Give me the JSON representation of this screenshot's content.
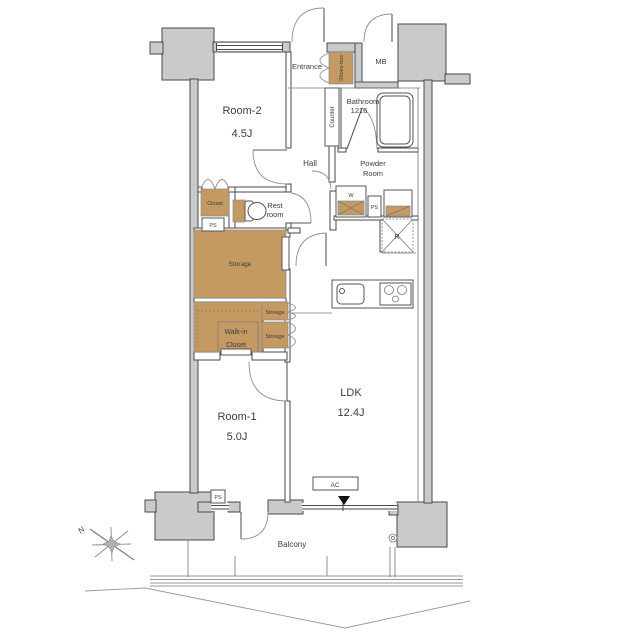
{
  "plan": {
    "rooms": {
      "room2": {
        "name": "Room-2",
        "size": "4.5J"
      },
      "room1": {
        "name": "Room-1",
        "size": "5.0J"
      },
      "ldk": {
        "name": "LDK",
        "size": "12.4J"
      },
      "entrance": {
        "name": "Entrance"
      },
      "hall": {
        "name": "Hall"
      },
      "bathroom": {
        "name": "Bathroom",
        "size": "1216"
      },
      "powder_room": {
        "line1": "Powder",
        "line2": "Room"
      },
      "rest_room": {
        "line1": "Rest",
        "line2": "room"
      },
      "balcony": {
        "name": "Balcony"
      }
    },
    "storage_areas": {
      "shoes_box": "Shoes-box",
      "closet": "Closet",
      "storage_main": "Storage",
      "walk_in_line1": "Walk-in",
      "walk_in_line2": "Closet",
      "storage_upper": "Storage",
      "storage_lower": "Storage",
      "counter": "Counter"
    },
    "labels": {
      "meter_box": "MB",
      "pipe_space": "PS",
      "washing_machine": "W",
      "refrigerator": "R",
      "air_conditioner": "AC",
      "north": "N"
    },
    "colors": {
      "wall": "#c9cacb",
      "tan": "#c59a62",
      "line": "#4a4a4a",
      "text": "#3c3c3c",
      "marker": "#111111"
    }
  }
}
